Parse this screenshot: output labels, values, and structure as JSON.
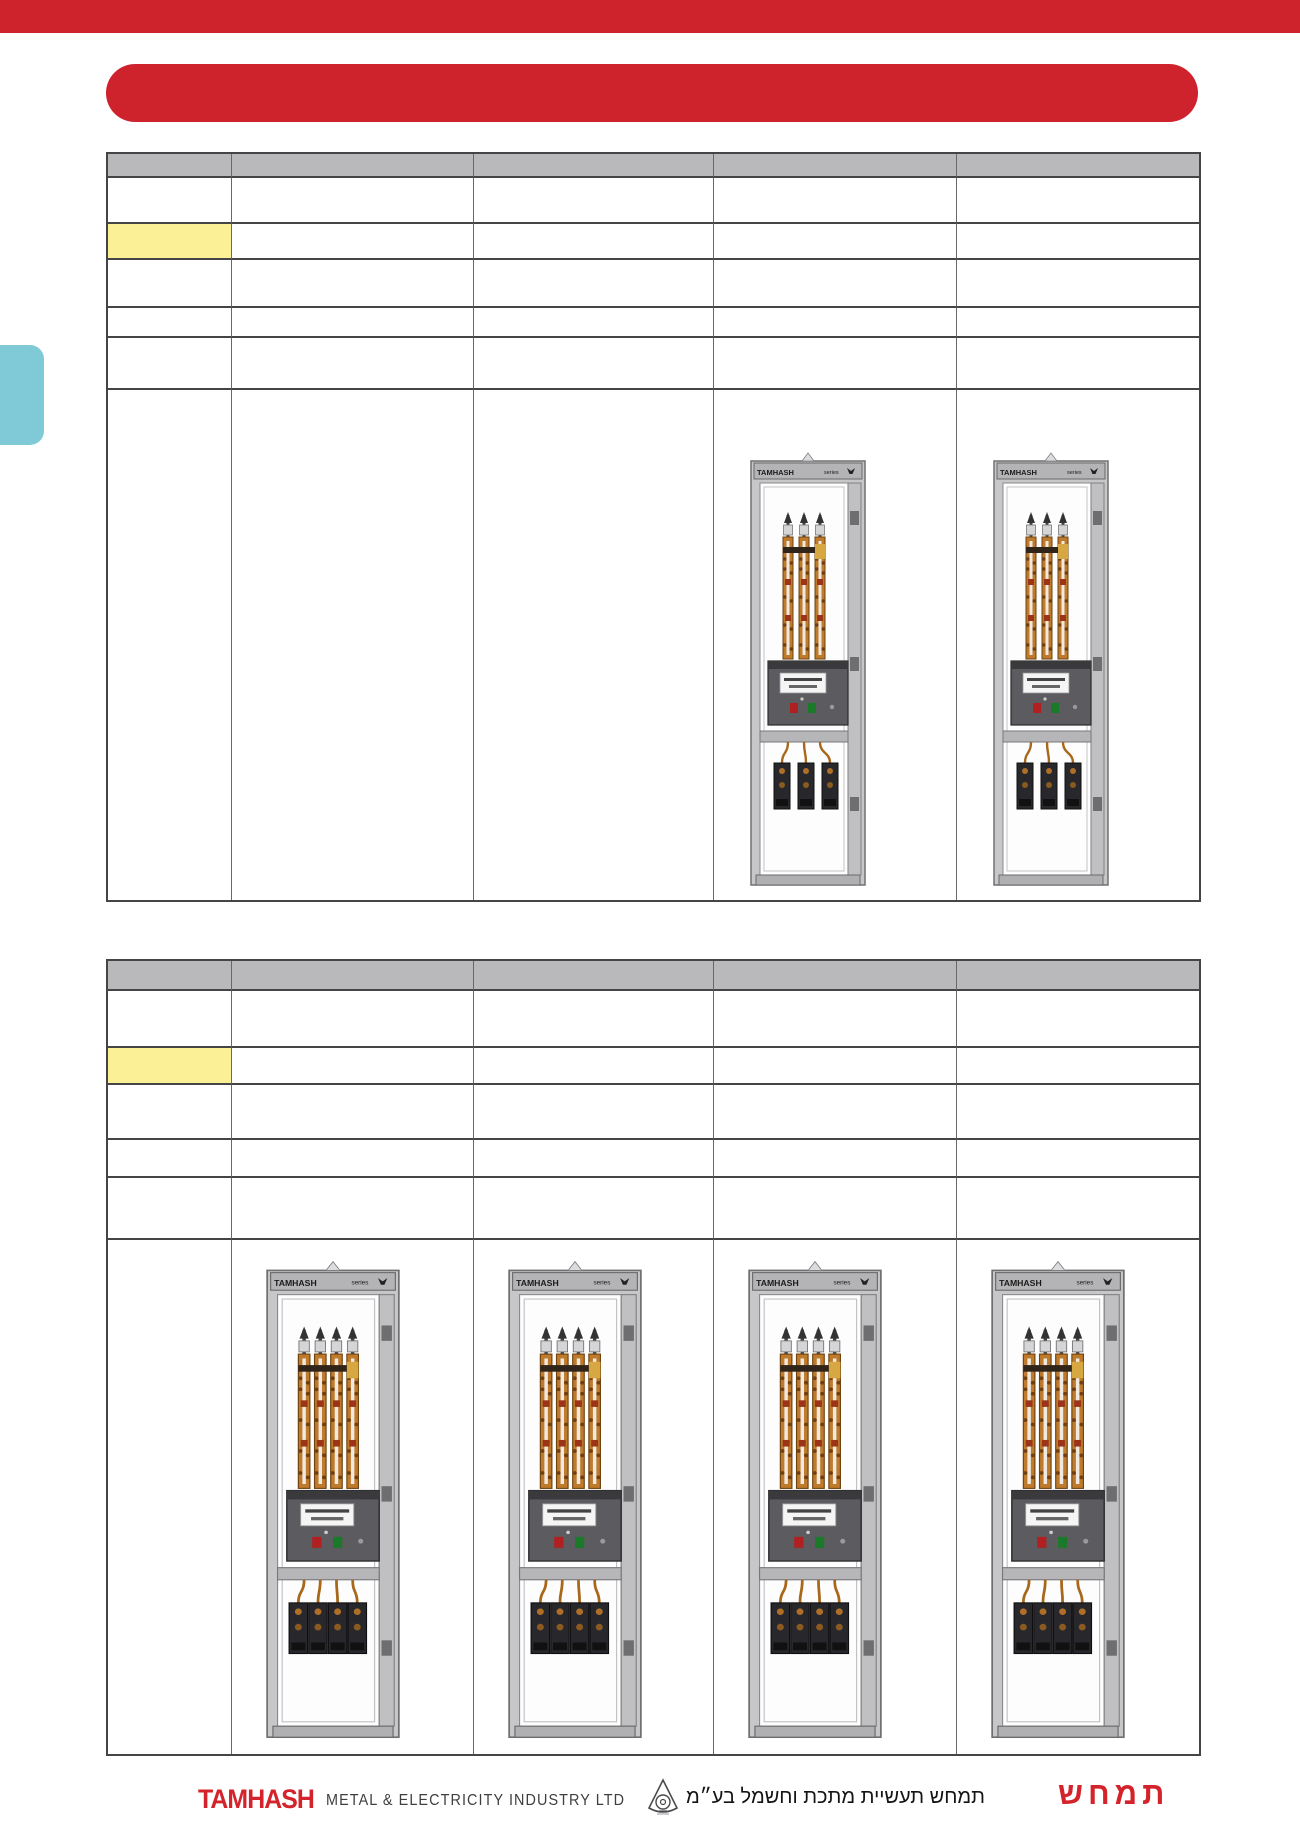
{
  "colors": {
    "accent_red": "#ce222c",
    "logo_red": "#d4232a",
    "header_gray": "#b9b9bb",
    "highlight_yellow": "#fbf095",
    "tab_blue": "#7fcad6"
  },
  "cabinets": {
    "brand": "TAMHASH",
    "series_label": "series",
    "table1_cabinets": [
      {
        "busbars": 3
      },
      {
        "busbars": 3
      }
    ],
    "table2_cabinets": [
      {
        "busbars": 4
      },
      {
        "busbars": 4
      },
      {
        "busbars": 4
      },
      {
        "busbars": 4
      }
    ]
  },
  "footer": {
    "logo_en": "TAMHASH",
    "company_en": "METAL &  ELECTRICITY  INDUSTRY  LTD",
    "company_he": "תמחש תעשיית מתכת וחשמל בע״מ",
    "logo_he": "תמחש"
  }
}
